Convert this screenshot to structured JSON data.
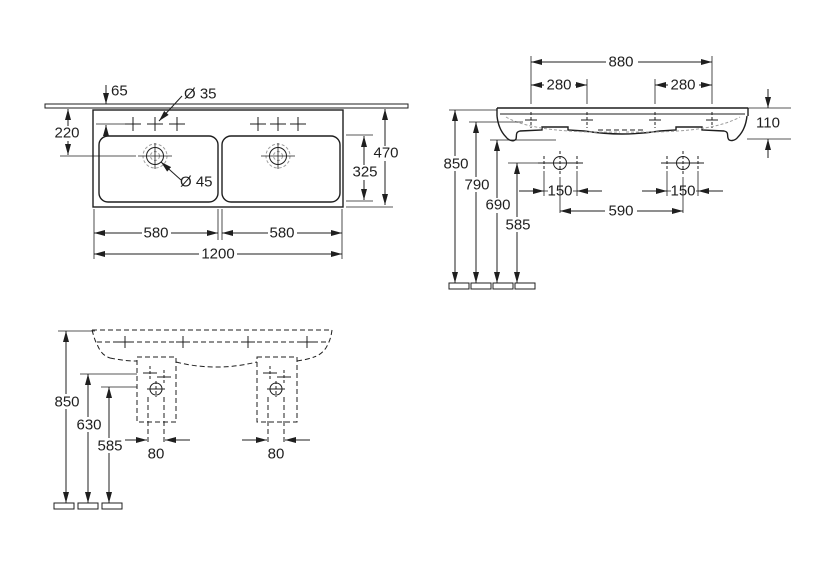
{
  "drawing": {
    "background_color": "#ffffff",
    "line_color": "#1f1f1f",
    "views": {
      "plan": {
        "dims": {
          "tap_hole_setback": "65",
          "tap_hole_diameter": "Ø 35",
          "drain_setback": "220",
          "drain_diameter": "Ø 45",
          "left_bowl_width": "580",
          "right_bowl_width": "580",
          "overall_width": "1200",
          "overall_depth": "470",
          "bowl_depth": "325"
        }
      },
      "side": {
        "dims": {
          "fixing_hole_span": "880",
          "fixing_offset_left": "280",
          "fixing_offset_right": "280",
          "rim_thickness": "110",
          "rim_height": "850",
          "underside_height": "790",
          "body_bottom_height": "690",
          "bolt_hole_height": "585",
          "bolt_spacing_left": "150",
          "bolt_spacing_right": "150",
          "bolt_centre_span": "590"
        }
      },
      "front": {
        "dims": {
          "rim_height": "850",
          "outlet_height": "630",
          "trap_height": "585",
          "pipe_clearance_left": "80",
          "pipe_clearance_right": "80"
        }
      }
    }
  }
}
